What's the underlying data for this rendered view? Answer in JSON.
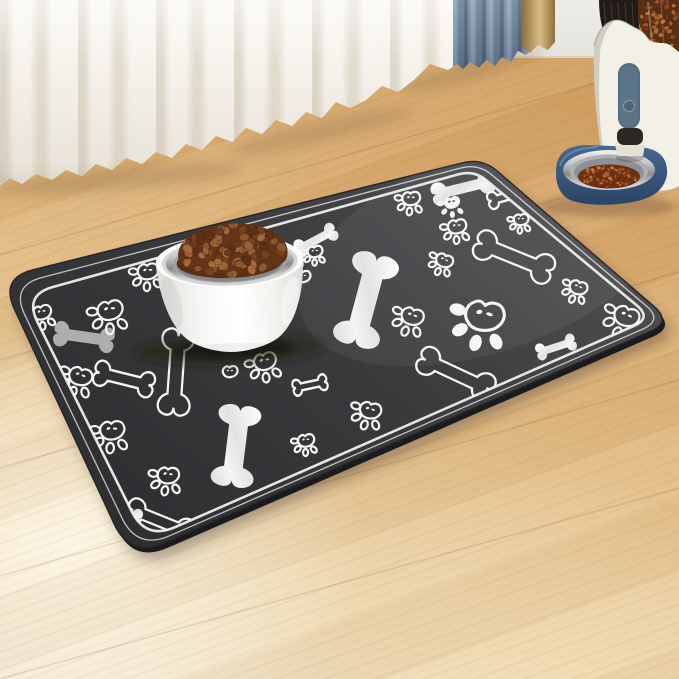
{
  "scene": {
    "width": 679,
    "height": 679
  },
  "palette": {
    "floor_warm": "#d5a365",
    "floor_pale": "#f1e4ca",
    "wall": "#edece8",
    "curtain_white": "#f5f2ec",
    "curtain_blue": "#6c8199",
    "curtain_tan": "#bd9d68",
    "mat_light": "#4b4b4e",
    "mat": "#3a3a3d",
    "mat_dark": "#2e2e31",
    "mat_side": "#1b1b1d",
    "mat_border": "#efefef",
    "pattern_white": "#f6f6f6",
    "pattern_gray": "#c9c9c9",
    "bowl_white": "#fbfbfa",
    "bowl_lip_shadow": "#d5d5d2",
    "steel_light": "#f2f2f1",
    "steel_mid": "#9fa0a3",
    "steel_dark": "#85868a",
    "food_base": "#5c2f14",
    "feeder_body": "#f2f0e5",
    "feeder_pill": "#526c80",
    "feeder_chute": "#2c2824",
    "feeder_base_top": "#4a6890",
    "feeder_base_bottom": "#2c4565",
    "hopper_dark": "#201b16",
    "hopper_food": "#5a2e12"
  },
  "floor": {
    "seams": [
      [
        0,
        150,
        679,
        -46
      ],
      [
        0,
        255,
        679,
        59
      ],
      [
        0,
        360,
        679,
        164
      ],
      [
        0,
        468,
        679,
        272
      ],
      [
        0,
        576,
        679,
        380
      ],
      [
        0,
        679,
        679,
        488
      ]
    ]
  },
  "mat": {
    "outer_corners": [
      [
        0,
        278
      ],
      [
        482,
        158
      ],
      [
        672,
        322
      ],
      [
        130,
        558
      ]
    ],
    "outer_radii": [
      34,
      20,
      24,
      38
    ],
    "inner_corners": [
      [
        24,
        295
      ],
      [
        474,
        170
      ],
      [
        652,
        318
      ],
      [
        146,
        540
      ]
    ],
    "inner_radii": [
      30,
      16,
      20,
      32
    ],
    "bones": [
      [
        "f",
        366,
        300,
        1.15,
        1.5,
        105
      ],
      [
        "f",
        463,
        188,
        0.78,
        0.75,
        -14
      ],
      [
        "f",
        236,
        446,
        1.0,
        1.35,
        97
      ],
      [
        "f",
        120,
        514,
        0.55,
        0.6,
        14
      ],
      [
        "f",
        556,
        347,
        0.5,
        0.55,
        -18
      ],
      [
        "f",
        316,
        240,
        0.55,
        0.6,
        -28
      ],
      [
        "g",
        84,
        337,
        0.74,
        0.8,
        8
      ],
      [
        "o",
        124,
        379,
        0.74,
        0.8,
        14
      ],
      [
        "o",
        514,
        257,
        1.0,
        0.95,
        22
      ],
      [
        "o",
        456,
        374,
        0.98,
        0.9,
        25
      ],
      [
        "o",
        160,
        521,
        0.85,
        0.8,
        22
      ],
      [
        "o",
        310,
        385,
        0.42,
        0.5,
        -12
      ],
      [
        "o",
        508,
        196,
        0.5,
        0.55,
        -16
      ],
      [
        "o",
        176,
        372,
        1.05,
        1.0,
        94
      ],
      [
        "o",
        322,
        482,
        0.45,
        0.5,
        -12
      ]
    ],
    "paws": [
      [
        "o",
        42,
        313,
        0.62,
        -15
      ],
      [
        "o",
        110,
        311,
        0.85,
        -12
      ],
      [
        "o",
        148,
        272,
        0.7,
        -8
      ],
      [
        "o",
        80,
        377,
        0.78,
        14
      ],
      [
        "o",
        112,
        431,
        0.82,
        -6
      ],
      [
        "o",
        113,
        503,
        0.8,
        10
      ],
      [
        "o",
        168,
        476,
        0.72,
        0
      ],
      [
        "o",
        265,
        362,
        0.75,
        -16
      ],
      [
        "o",
        315,
        252,
        0.5,
        -10
      ],
      [
        "o",
        412,
        317,
        0.75,
        14
      ],
      [
        "o",
        444,
        261,
        0.58,
        18
      ],
      [
        "o",
        457,
        227,
        0.62,
        -10
      ],
      [
        "o",
        411,
        199,
        0.6,
        -5
      ],
      [
        "o",
        578,
        288,
        0.6,
        16
      ],
      [
        "o",
        626,
        317,
        0.85,
        18
      ],
      [
        "o",
        627,
        226,
        0.65,
        14
      ],
      [
        "o",
        521,
        220,
        0.5,
        -6
      ],
      [
        "o",
        370,
        411,
        0.72,
        10
      ],
      [
        "o",
        306,
        441,
        0.55,
        -10
      ],
      [
        "m",
        484,
        317,
        1.3,
        6
      ],
      [
        "f",
        452,
        203,
        0.55,
        -14
      ]
    ],
    "hearts": [
      [
        303,
        277,
        0.5,
        -8
      ],
      [
        230,
        372,
        0.5,
        -5
      ]
    ]
  },
  "bowl": {
    "cx": 231,
    "cy": 261,
    "rim_rx": 74,
    "rim_ry": 26,
    "bottom_y": 352,
    "rotate": -2,
    "kibble": {
      "count": 95,
      "seed": 7,
      "colors": [
        "#8a5531",
        "#74421f",
        "#9a6136",
        "#6b3a1c",
        "#a36a3d",
        "#5f3114"
      ]
    }
  },
  "feeder": {
    "pill": {
      "x": 618,
      "y": 63,
      "w": 22,
      "h": 66
    },
    "button": {
      "cx": 629,
      "cy": 106,
      "r": 5.5
    },
    "bowl": {
      "cx": 609,
      "cy": 170,
      "rx": 46,
      "ry": 20
    },
    "food": {
      "count": 85,
      "seed": 11,
      "colors": [
        "#a0522b",
        "#8a3f1c",
        "#b5652f",
        "#7c3514",
        "#c27a3d"
      ]
    },
    "hopper": {
      "count": 48,
      "seed": 23,
      "colors": [
        "#8a4a22",
        "#a65f2e",
        "#74361a",
        "#b06c34"
      ]
    }
  }
}
